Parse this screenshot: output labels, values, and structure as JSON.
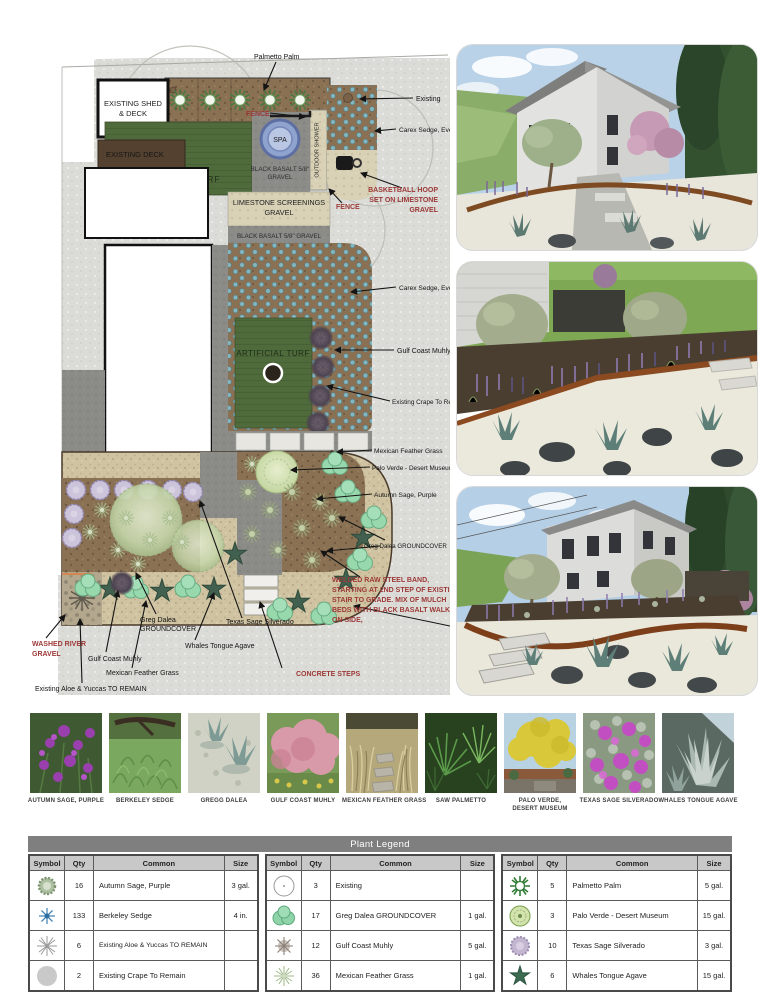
{
  "colors": {
    "red_annotation": "#9c3937",
    "turf_green": "#4f6a3b",
    "mulch_brown": "#8a7154",
    "street_gray": "#dbdbd7",
    "legend_title_bg": "#7f7f7f",
    "legend_header_bg": "#c8c8c8"
  },
  "plan": {
    "zone_labels": {
      "shed1": "EXISTING SHED",
      "shed2": "& DECK",
      "deck": "EXISTING DECK",
      "turf1": "ARTIFICIAL TURF",
      "turf2": "ARTIFICIAL TURF",
      "spa": "SPA",
      "shower": "OUTDOOR SHOWER",
      "basalt1a": "BLACK BASALT 5/8\"",
      "basalt1b": "GRAVEL",
      "lime1": "LIMESTONE SCREENINGS",
      "lime2": "GRAVEL",
      "basalt2": "BLACK BASALT 5/8\" GRAVEL",
      "basalt3": "BLACK BASALT 5/8\" GRAVEL"
    },
    "callouts": {
      "palmetto": "Palmetto Palm",
      "existing": "Existing",
      "carex1": "Carex Sedge, Evercolor",
      "carex2": "Carex Sedge, Evercolor",
      "muhly_r": "Gulf Coast Muhly",
      "crape": "Existing Crape To Remain",
      "mexfg_r": "Mexican Feather Grass",
      "palo": "Palo Verde  - Desert Museum",
      "sage_r": "Autumn Sage, Purple",
      "dalea_r": "Greg Dalea GROUNDCOVER",
      "texas": "Texas Sage Silverado",
      "whales": "Whales Tongue Agave",
      "dalea_b1": "Greg Dalea",
      "dalea_b2": "GROUNDCOVER",
      "muhly_b": "Gulf Coast Muhly",
      "mexfg_b": "Mexican Feather Grass",
      "aloe": "Existing Aloe & Yuccas TO REMAIN"
    },
    "red_callouts": {
      "fence1": "FENCE",
      "fence2": "FENCE",
      "bball1": "BASKETBALL HOOP",
      "bball2": "SET ON LIMESTONE",
      "bball3": "GRAVEL",
      "welded1": "WELDED RAW STEEL BAND,",
      "welded2": "STARTING AT 2ND STEP OF EXISTING",
      "welded3": "STAIR TO GRADE. MIX OF MULCH",
      "welded4": "BEDS WITH BLACK BASALT WALKWAY",
      "welded5": "ON SIDE,",
      "washed1": "WASHED RIVER",
      "washed2": "GRAVEL",
      "steps": "CONCRETE STEPS"
    }
  },
  "photos": [
    {
      "caption": "AUTUMN SAGE, PURPLE"
    },
    {
      "caption": "BERKELEY SEDGE"
    },
    {
      "caption": "GREGG DALEA"
    },
    {
      "caption": "GULF COAST MUHLY"
    },
    {
      "caption": "MEXICAN FEATHER GRASS"
    },
    {
      "caption": "SAW PALMETTO"
    },
    {
      "caption": "PALO VERDE,\nDESERT MUSEUM"
    },
    {
      "caption": "TEXAS SAGE SILVERADO"
    },
    {
      "caption": "WHALES TONGUE AGAVE"
    }
  ],
  "legend": {
    "title": "Plant Legend",
    "headers": {
      "symbol": "Symbol",
      "qty": "Qty",
      "common": "Common",
      "size": "Size"
    },
    "groups": [
      {
        "rows": [
          {
            "qty": "16",
            "common": "Autumn Sage, Purple",
            "size": "3 gal."
          },
          {
            "qty": "133",
            "common": "Berkeley Sedge",
            "size": "4 in."
          },
          {
            "qty": "6",
            "common": "Existing Aloe & Yuccas TO REMAIN",
            "size": ""
          },
          {
            "qty": "2",
            "common": "Existing Crape To Remain",
            "size": ""
          }
        ]
      },
      {
        "rows": [
          {
            "qty": "3",
            "common": "Existing",
            "size": ""
          },
          {
            "qty": "17",
            "common": "Greg Dalea GROUNDCOVER",
            "size": "1 gal."
          },
          {
            "qty": "12",
            "common": "Gulf Coast Muhly",
            "size": "5 gal."
          },
          {
            "qty": "36",
            "common": "Mexican Feather Grass",
            "size": "1 gal."
          }
        ]
      },
      {
        "rows": [
          {
            "qty": "5",
            "common": "Palmetto Palm",
            "size": "5 gal."
          },
          {
            "qty": "3",
            "common": "Palo Verde  - Desert Museum",
            "size": "15 gal."
          },
          {
            "qty": "10",
            "common": "Texas Sage Silverado",
            "size": "3 gal."
          },
          {
            "qty": "6",
            "common": "Whales Tongue Agave",
            "size": "15 gal."
          }
        ]
      }
    ]
  }
}
